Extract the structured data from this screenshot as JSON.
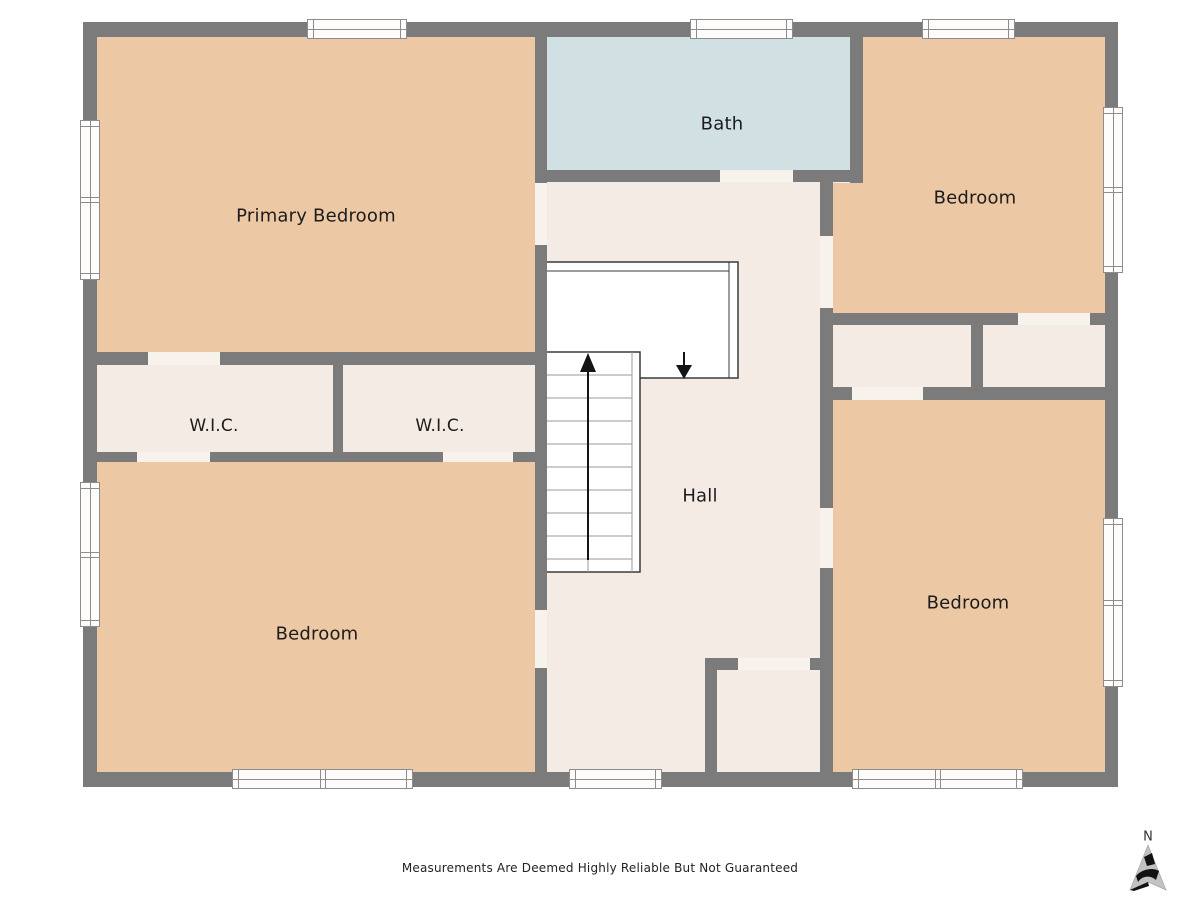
{
  "plan": {
    "rooms": {
      "primary_bedroom": {
        "label": "Primary Bedroom"
      },
      "bath": {
        "label": "Bath"
      },
      "bedroom_top_right": {
        "label": "Bedroom"
      },
      "wic_left": {
        "label": "W.I.C."
      },
      "wic_right": {
        "label": "W.I.C."
      },
      "hall": {
        "label": "Hall"
      },
      "bedroom_bottom_left": {
        "label": "Bedroom"
      },
      "bedroom_bottom_right": {
        "label": "Bedroom"
      }
    },
    "compass": {
      "north_label": "N"
    },
    "disclaimer": "Measurements Are Deemed Highly Reliable But Not Guaranteed",
    "colors": {
      "wall": "#7b7b7b",
      "bedroom_fill": "#ecc8a4",
      "bath_fill": "#d1e0e3",
      "floor_fill": "#f4ebe5",
      "door_gap": "#f8f2ec",
      "stairs_outline": "#3a3a3a",
      "tread_line": "#9a9a9a",
      "window_frame": "#8d8d8d",
      "label_color": "#1c1c1c"
    }
  }
}
